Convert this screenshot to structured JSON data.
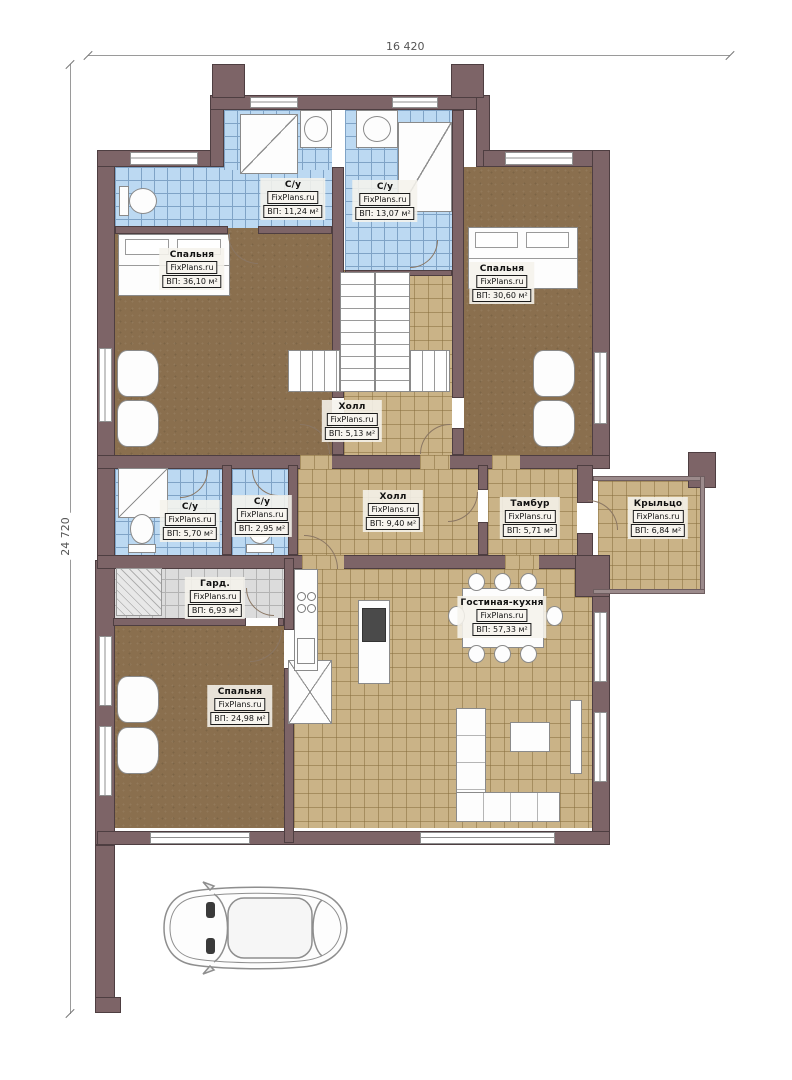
{
  "watermark": "FixPlans.ru",
  "dimensions": {
    "width_mm": "16 420",
    "height_mm": "24 720"
  },
  "rooms": [
    {
      "name": "Спальня",
      "area": "ВП: 36,10 м²"
    },
    {
      "name": "С/у",
      "area": "ВП: 11,24 м²"
    },
    {
      "name": "С/у",
      "area": "ВП: 13,07 м²"
    },
    {
      "name": "Спальня",
      "area": "ВП: 30,60 м²"
    },
    {
      "name": "Холл",
      "area": "ВП: 5,13 м²"
    },
    {
      "name": "С/у",
      "area": "ВП: 5,70 м²"
    },
    {
      "name": "С/у",
      "area": "ВП: 2,95 м²"
    },
    {
      "name": "Холл",
      "area": "ВП: 9,40 м²"
    },
    {
      "name": "Тамбур",
      "area": "ВП: 5,71 м²"
    },
    {
      "name": "Крыльцо",
      "area": "ВП: 6,84 м²"
    },
    {
      "name": "Гард.",
      "area": "ВП: 6,93 м²"
    },
    {
      "name": "Гостиная-кухня",
      "area": "ВП: 57,33 м²"
    },
    {
      "name": "Спальня",
      "area": "ВП: 24,98 м²"
    }
  ],
  "colors": {
    "wall": "#7d6467",
    "floor_wood": "#8a6f4e",
    "tile_blue": "#bcd9f2",
    "tile_tan": "#cab387",
    "tile_gray": "#dcdcdc"
  }
}
